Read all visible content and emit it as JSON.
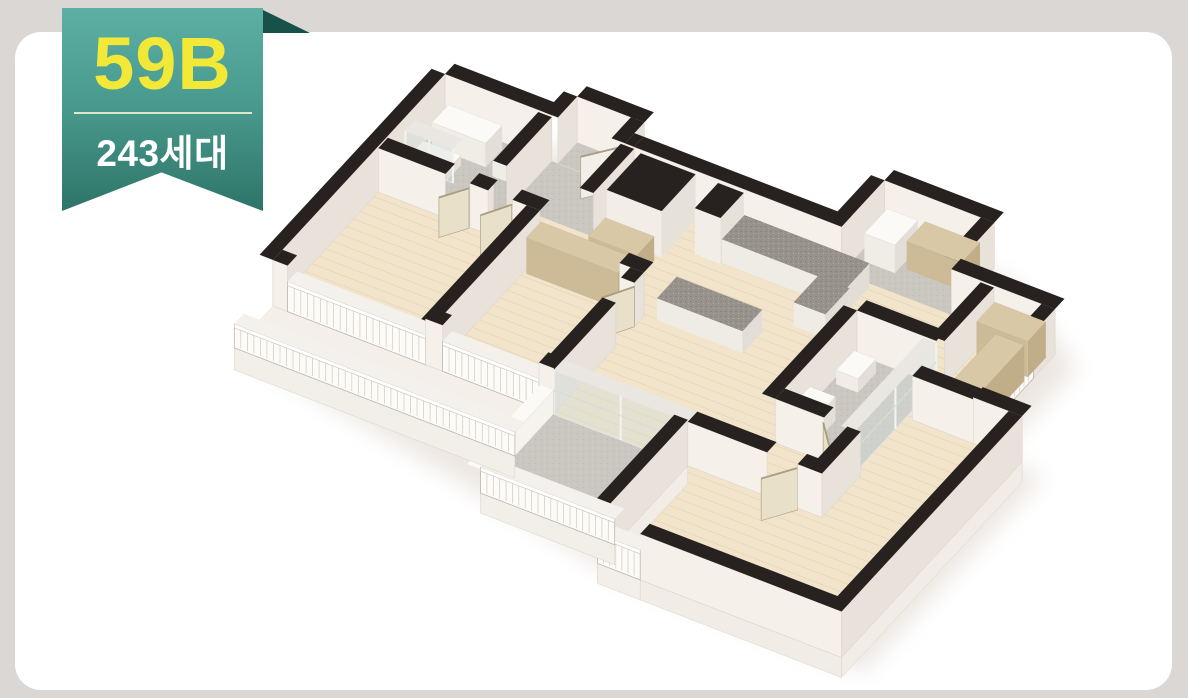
{
  "badge": {
    "type_label": "59B",
    "units_label": "243세대"
  },
  "palette": {
    "ribbon_top": "#5CAFA3",
    "ribbon_bottom": "#2E7468",
    "ribbon_fold": "#175149",
    "type_text": "#F2E838",
    "units_text": "#FFFFFF",
    "divider": "#F8F5D2",
    "frame_bg": "#DBD7D4",
    "card_bg": "#FFFFFF",
    "wall_cap": "#272220",
    "wall_face_south": "#F5F0E9",
    "wall_face_east": "#E8E2DA",
    "wood_floor": "#F1E4CA",
    "wood_plank_line": "#E4D5B6",
    "tile_floor": "#CAC6C0",
    "counter_top": "#98938C",
    "wardrobe": "#D9C8A6",
    "door": "#E9E0C9"
  },
  "floor_plan": {
    "label": "3D isometric apartment floor plan, unit type 59B"
  }
}
